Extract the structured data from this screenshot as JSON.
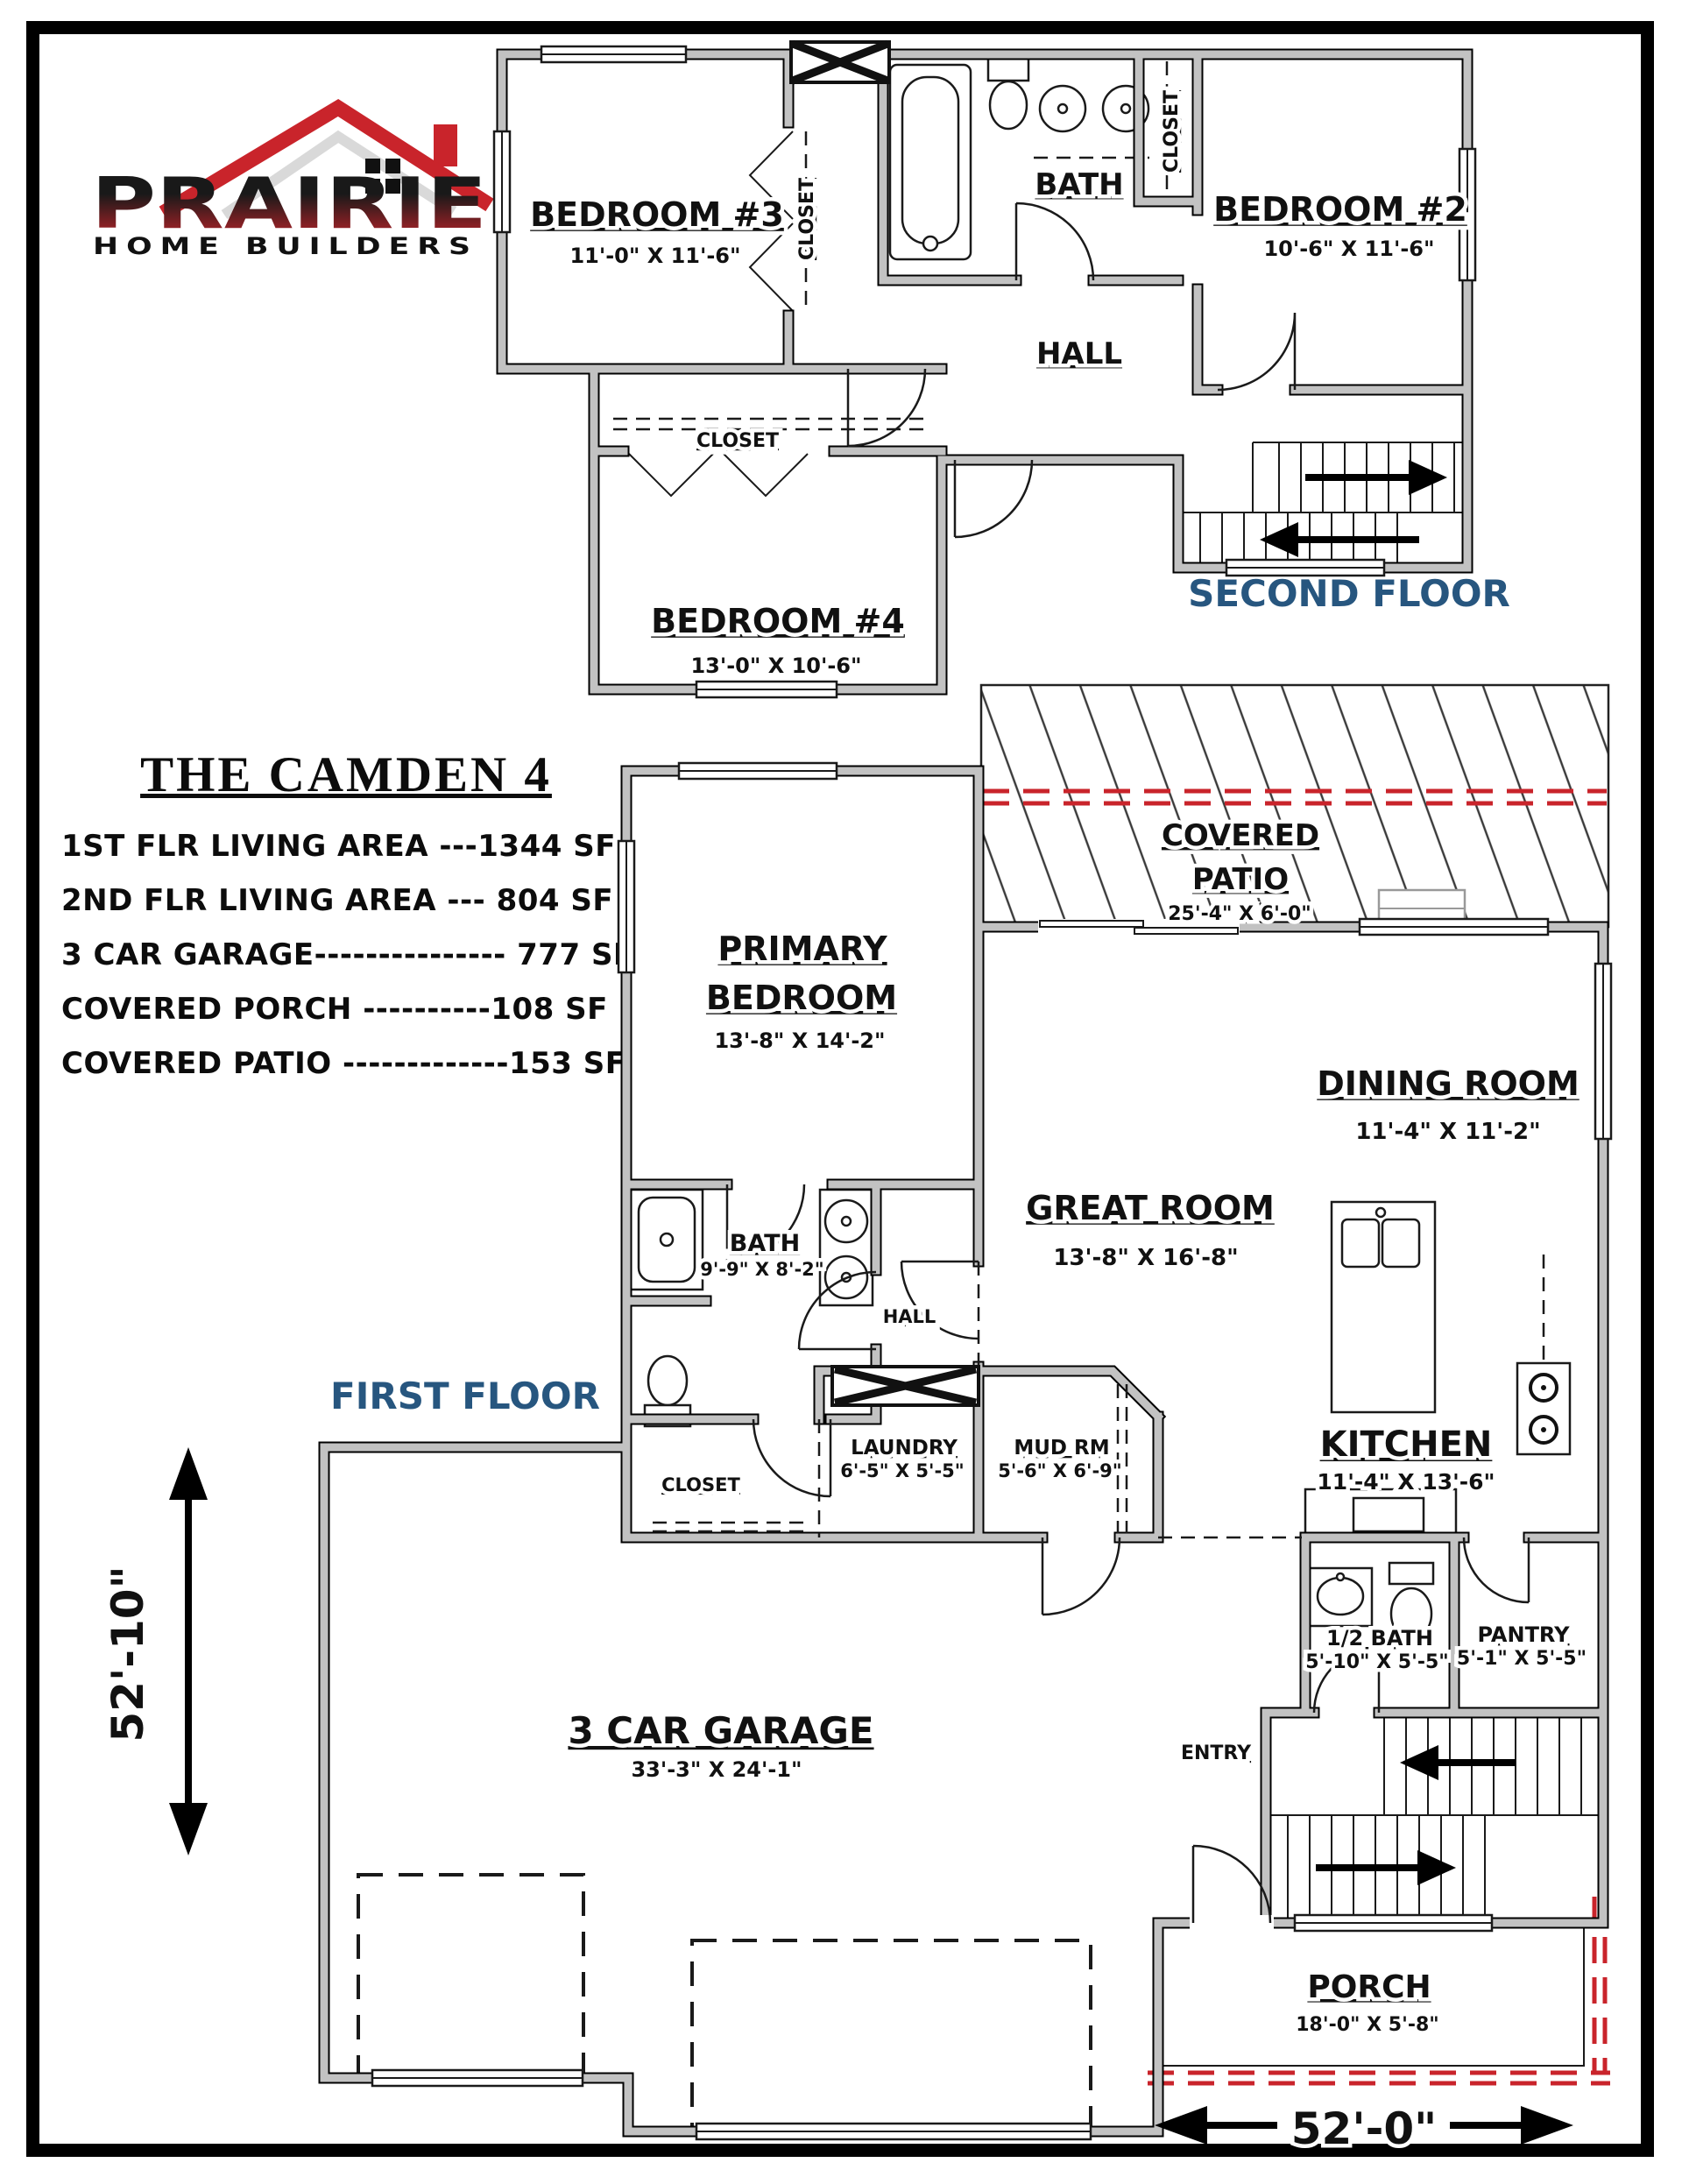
{
  "logo": {
    "brand": "PRAIRIE",
    "tagline": "HOME BUILDERS"
  },
  "title": "THE CAMDEN 4",
  "stats": [
    "1ST FLR LIVING AREA ---1344 SF",
    "2ND FLR LIVING AREA --- 804 SF",
    "3 CAR GARAGE--------------- 777 SF",
    "COVERED PORCH ----------108 SF",
    "COVERED PATIO -------------153 SF"
  ],
  "second": {
    "label": "SECOND FLOOR",
    "bedroom3": {
      "name": "BEDROOM #3",
      "dim": "11'-0\" X 11'-6\""
    },
    "closet_bath": {
      "name": "CLOSET"
    },
    "bath": {
      "name": "BATH"
    },
    "closet_b2": {
      "name": "CLOSET"
    },
    "bedroom2": {
      "name": "BEDROOM #2",
      "dim": "10'-6\" X 11'-6\""
    },
    "hall": {
      "name": "HALL"
    },
    "closet_b4": {
      "name": "CLOSET"
    },
    "bedroom4": {
      "name": "BEDROOM #4",
      "dim": "13'-0\" X 10'-6\""
    }
  },
  "first": {
    "label": "FIRST FLOOR",
    "patio": {
      "name1": "COVERED",
      "name2": "PATIO",
      "dim": "25'-4\" X 6'-0\""
    },
    "primary": {
      "name1": "PRIMARY",
      "name2": "BEDROOM",
      "dim": "13'-8\" X 14'-2\""
    },
    "dining": {
      "name": "DINING ROOM",
      "dim": "11'-4\" X 11'-2\""
    },
    "great": {
      "name": "GREAT ROOM",
      "dim": "13'-8\" X 16'-8\""
    },
    "bath": {
      "name": "BATH",
      "dim": "9'-9\" X 8'-2\""
    },
    "hall": {
      "name": "HALL"
    },
    "closet": {
      "name": "CLOSET"
    },
    "laundry": {
      "name": "LAUNDRY",
      "dim": "6'-5\" X 5'-5\""
    },
    "mud": {
      "name": "MUD RM",
      "dim": "5'-6\" X 6'-9\""
    },
    "kitchen": {
      "name": "KITCHEN",
      "dim": "11'-4\" X 13'-6\""
    },
    "half_bath": {
      "name": "1/2 BATH",
      "dim": "5'-10\" X 5'-5\""
    },
    "pantry": {
      "name": "PANTRY",
      "dim": "5'-1\" X 5'-5\""
    },
    "entry": {
      "name": "ENTRY"
    },
    "garage": {
      "name": "3 CAR GARAGE",
      "dim": "33'-3\" X 24'-1\""
    },
    "porch": {
      "name": "PORCH",
      "dim": "18'-0\" X 5'-8\""
    }
  },
  "dims": {
    "height": "52'-10\"",
    "width": "52'-0\""
  },
  "colors": {
    "accent_red": "#C9242B",
    "label_blue": "#27567F",
    "wall_gray": "#C2C2C2",
    "logo_red": "#C9242B"
  }
}
